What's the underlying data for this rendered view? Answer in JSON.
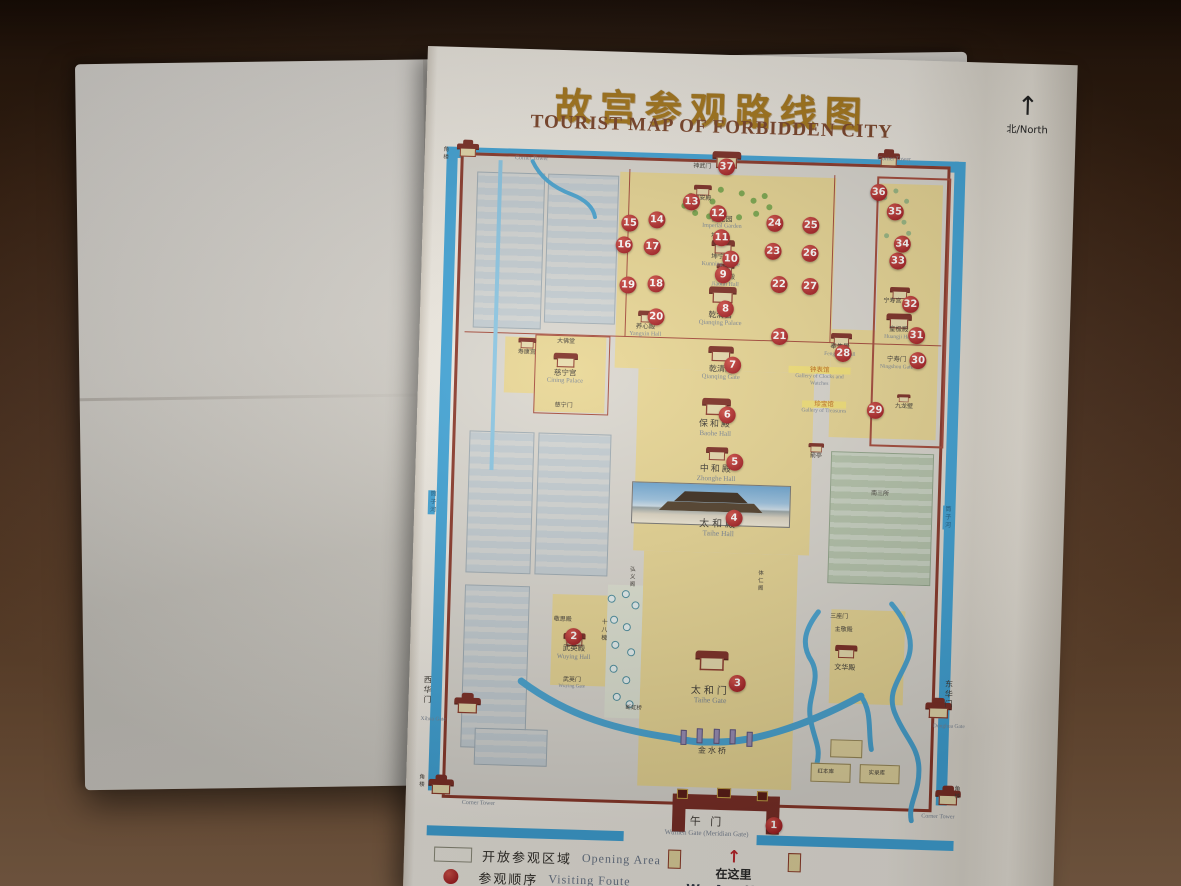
{
  "header": {
    "title_zh": "故宫参观路线图",
    "title_en": "TOURIST MAP OF FORBIDDEN CITY",
    "north_arrow": "↑",
    "north_label": "北/North"
  },
  "legend": {
    "items": [
      {
        "swatch": "area",
        "color": "#e9d795",
        "zh": "开放参观区域",
        "en": "Opening Area"
      },
      {
        "swatch": "dot",
        "color": "#b5282a",
        "zh": "参观顺序",
        "en": "Visiting Foute"
      }
    ]
  },
  "you_are_here": {
    "arrow": "↑",
    "zh": "在这里",
    "en": "We Are Here"
  },
  "colors": {
    "marker_red": "#b5282a",
    "open_area": "#e9d795",
    "moat_blue": "#41a5d9",
    "wall_red": "#8c392b",
    "title_gold": "#a8791c"
  },
  "map": {
    "markers": [
      {
        "n": 1,
        "x": 65.1,
        "y": 96.7
      },
      {
        "n": 2,
        "x": 27.6,
        "y": 70.6
      },
      {
        "n": 3,
        "x": 57.7,
        "y": 76.6
      },
      {
        "n": 4,
        "x": 56.2,
        "y": 53.0
      },
      {
        "n": 5,
        "x": 56.0,
        "y": 45.0
      },
      {
        "n": 6,
        "x": 54.4,
        "y": 38.3
      },
      {
        "n": 7,
        "x": 55.1,
        "y": 31.1
      },
      {
        "n": 8,
        "x": 53.5,
        "y": 23.1
      },
      {
        "n": 9,
        "x": 52.9,
        "y": 18.3
      },
      {
        "n": 10,
        "x": 54.2,
        "y": 16.0
      },
      {
        "n": 11,
        "x": 52.4,
        "y": 13.0
      },
      {
        "n": 12,
        "x": 51.6,
        "y": 9.6
      },
      {
        "n": 13,
        "x": 46.7,
        "y": 8.0
      },
      {
        "n": 14,
        "x": 40.5,
        "y": 10.7
      },
      {
        "n": 15,
        "x": 35.6,
        "y": 11.3
      },
      {
        "n": 16,
        "x": 34.7,
        "y": 14.4
      },
      {
        "n": 17,
        "x": 39.8,
        "y": 14.6
      },
      {
        "n": 18,
        "x": 40.7,
        "y": 19.9
      },
      {
        "n": 19,
        "x": 35.6,
        "y": 20.1
      },
      {
        "n": 20,
        "x": 40.9,
        "y": 24.6
      },
      {
        "n": 21,
        "x": 63.5,
        "y": 26.9
      },
      {
        "n": 22,
        "x": 63.1,
        "y": 19.4
      },
      {
        "n": 23,
        "x": 61.9,
        "y": 14.7
      },
      {
        "n": 24,
        "x": 62.0,
        "y": 10.7
      },
      {
        "n": 25,
        "x": 68.6,
        "y": 10.9
      },
      {
        "n": 26,
        "x": 68.6,
        "y": 14.9
      },
      {
        "n": 27,
        "x": 68.8,
        "y": 19.6
      },
      {
        "n": 28,
        "x": 75.2,
        "y": 29.0
      },
      {
        "n": 29,
        "x": 81.4,
        "y": 37.0
      },
      {
        "n": 30,
        "x": 88.9,
        "y": 29.7
      },
      {
        "n": 31,
        "x": 88.5,
        "y": 26.1
      },
      {
        "n": 32,
        "x": 87.2,
        "y": 21.7
      },
      {
        "n": 33,
        "x": 84.7,
        "y": 15.6
      },
      {
        "n": 34,
        "x": 85.4,
        "y": 13.1
      },
      {
        "n": 35,
        "x": 83.9,
        "y": 8.6
      },
      {
        "n": 36,
        "x": 80.8,
        "y": 5.9
      },
      {
        "n": 37,
        "x": 52.9,
        "y": 2.9
      }
    ],
    "labels": [
      {
        "id": "wumen",
        "t": "午 门",
        "e": "Wumen Gate (Meridian Gate)",
        "x": 52.9,
        "y": 97.2,
        "zs": 11,
        "es": 7,
        "sp": 3
      },
      {
        "id": "jinshuiqiao",
        "t": "金水桥",
        "x": 53.6,
        "y": 86.3,
        "zs": 8,
        "sp": 2
      },
      {
        "id": "taihe-gate",
        "t": "太和门",
        "e": "Taihe Gate",
        "x": 52.8,
        "y": 78.4,
        "zs": 10,
        "es": 7.5,
        "sp": 3
      },
      {
        "id": "taihe-hall",
        "t": "太和殿",
        "e": "Taihe Hall",
        "x": 53.4,
        "y": 54.5,
        "zs": 10,
        "es": 7.5,
        "sp": 3
      },
      {
        "id": "zhonghe-hall",
        "t": "中和殿",
        "e": "Zhonghe Hall",
        "x": 52.7,
        "y": 46.7,
        "zs": 9,
        "es": 7,
        "sp": 2
      },
      {
        "id": "baohe-hall",
        "t": "保和殿",
        "e": "Baohe Hall",
        "x": 52.3,
        "y": 40.3,
        "zs": 9,
        "es": 7,
        "sp": 2
      },
      {
        "id": "qianqing-gate",
        "t": "乾清门",
        "e": "Qianqing Gate",
        "x": 53.0,
        "y": 32.3,
        "zs": 8,
        "es": 6.5
      },
      {
        "id": "qianqing-palace",
        "t": "乾清宫",
        "e": "Qianqing Palace",
        "x": 52.6,
        "y": 24.5,
        "zs": 8,
        "es": 6.5
      },
      {
        "id": "jiaotai-hall",
        "t": "交泰殿",
        "e": "Jiaotai Hall",
        "x": 53.3,
        "y": 19.2,
        "zs": 6.5,
        "es": 6
      },
      {
        "id": "kunning-palace",
        "t": "坤宁宫",
        "e": "Kunning Palace",
        "x": 52.4,
        "y": 16.3,
        "zs": 6.5,
        "es": 6
      },
      {
        "id": "kunning-gate",
        "t": "坤宁门",
        "x": 52.1,
        "y": 12.9,
        "zs": 6
      },
      {
        "id": "imperial-garden",
        "t": "御花园",
        "e": "Imperial Garden",
        "x": 52.4,
        "y": 10.9,
        "zs": 7,
        "es": 6
      },
      {
        "id": "qinan-hall",
        "t": "钦安殿",
        "x": 48.7,
        "y": 7.6,
        "zs": 6
      },
      {
        "id": "shenwu-gate",
        "t": "神武门",
        "x": 48.5,
        "y": 3.0,
        "zs": 6
      },
      {
        "id": "cining-palace",
        "t": "慈宁宫",
        "e": "Cining Palace",
        "x": 24.6,
        "y": 33.5,
        "zs": 7.5,
        "es": 6.5
      },
      {
        "id": "cining-gate",
        "t": "慈宁门",
        "x": 24.5,
        "y": 37.7,
        "zs": 6
      },
      {
        "id": "dafotang",
        "t": "大佛堂",
        "x": 24.6,
        "y": 28.6,
        "zs": 6
      },
      {
        "id": "shoukang-palace",
        "t": "寿康宫",
        "x": 17.5,
        "y": 30.3,
        "zs": 6
      },
      {
        "id": "yangxin-hall",
        "t": "养心殿",
        "e": "Yangxin Hall",
        "x": 39.0,
        "y": 26.6,
        "zs": 6.5,
        "es": 6
      },
      {
        "id": "fengxian-hall",
        "t": "奉先殿",
        "e": "Fengxian Hall",
        "x": 74.6,
        "y": 28.6,
        "zs": 6.5,
        "es": 5.5
      },
      {
        "id": "clocks-gallery",
        "t": "钟表馆",
        "e": "Gallery of Clocks and Watches",
        "x": 71.0,
        "y": 32.4,
        "zs": 6.5,
        "es": 5.5,
        "hl": 1,
        "w": 62
      },
      {
        "id": "treasures-gallery",
        "t": "珍宝馆",
        "e": "Gallery of Treasures",
        "x": 72.0,
        "y": 36.8,
        "zs": 6.5,
        "es": 5.5,
        "hl": 1
      },
      {
        "id": "nine-dragon-screen",
        "t": "九龙壁",
        "x": 86.6,
        "y": 36.4,
        "zs": 6
      },
      {
        "id": "ningshou-palace",
        "t": "宁寿宫",
        "x": 83.9,
        "y": 21.4,
        "zs": 6
      },
      {
        "id": "huangji-hall",
        "t": "皇极殿",
        "e": "Huangji Hall",
        "x": 85.2,
        "y": 25.9,
        "zs": 6.5,
        "es": 5.5
      },
      {
        "id": "ningshou-gate",
        "t": "宁寿门",
        "e": "Ningshou Gate",
        "x": 85.0,
        "y": 30.2,
        "zs": 6.5,
        "es": 5.5
      },
      {
        "id": "sanzuomen",
        "t": "三座门",
        "x": 75.9,
        "y": 66.7,
        "zs": 6
      },
      {
        "id": "zhujing-hall",
        "t": "主敬殿",
        "x": 76.8,
        "y": 68.6,
        "zs": 6
      },
      {
        "id": "wenhua-hall",
        "t": "文华殿",
        "x": 77.2,
        "y": 73.9,
        "zs": 7
      },
      {
        "id": "wuying-hall",
        "t": "武英殿",
        "e": "Wuying Hall",
        "x": 27.7,
        "y": 72.9,
        "zs": 7.5,
        "es": 6.5
      },
      {
        "id": "wuying-gate",
        "t": "武英门",
        "e": "Wuying Gate",
        "x": 27.5,
        "y": 77.3,
        "zs": 6,
        "es": 5
      },
      {
        "id": "jingsi-hall",
        "t": "敬思殿",
        "x": 25.5,
        "y": 68.3,
        "zs": 6
      },
      {
        "id": "shibahuai",
        "t": "十八槐",
        "x": 32.8,
        "y": 69.5,
        "zs": 6,
        "v": 1
      },
      {
        "id": "duanhong-bridge",
        "t": "断虹桥",
        "x": 38.9,
        "y": 80.6,
        "zs": 5.5
      },
      {
        "id": "xihua-gate",
        "t": "西华门",
        "x": 1.2,
        "y": 78.8,
        "zs": 8,
        "v": 1
      },
      {
        "id": "xihua-gate-en",
        "e": "Xihua Gate",
        "x": 2.4,
        "y": 83.0,
        "es": 5.5
      },
      {
        "id": "donghua-gate",
        "t": "东华门",
        "x": 96.3,
        "y": 77.3,
        "zs": 8,
        "v": 1
      },
      {
        "id": "donghua-gate-en",
        "e": "Donghua Gate",
        "x": 96.5,
        "y": 81.8,
        "es": 5.5
      },
      {
        "id": "tongzi-river-west",
        "t": "筒子河",
        "x": 0.9,
        "y": 52.0,
        "zs": 6,
        "v": 1,
        "moat": 1
      },
      {
        "id": "tongzi-river-east",
        "t": "筒子河",
        "x": 94.9,
        "y": 52.0,
        "zs": 6,
        "v": 1,
        "moat": 1
      },
      {
        "id": "corner-tower-nw-en",
        "e": "Corner Tower",
        "x": 17.3,
        "y": 2.6,
        "es": 6
      },
      {
        "id": "corner-tower-ne-en",
        "e": "Corner Tower",
        "x": 83.5,
        "y": 1.2,
        "es": 6
      },
      {
        "id": "corner-tower-sw-en",
        "e": "Corner Tower",
        "x": 11.1,
        "y": 94.8,
        "es": 6
      },
      {
        "id": "corner-tower-se-en",
        "e": "Corner Tower",
        "x": 95.0,
        "y": 94.9,
        "es": 6
      },
      {
        "id": "corner-tower-nw-zh",
        "t": "角楼",
        "x": 1.5,
        "y": 2.2,
        "zs": 5.5,
        "v": 1
      },
      {
        "id": "corner-tower-sw-zh",
        "t": "角楼",
        "x": 0.5,
        "y": 91.9,
        "zs": 5.5,
        "v": 1
      },
      {
        "id": "corner-tower-se-zh",
        "t": "角楼",
        "x": 98.2,
        "y": 91.3,
        "zs": 5.5,
        "v": 1
      },
      {
        "id": "hongbenku",
        "t": "红本库",
        "x": 74.3,
        "y": 88.8,
        "zs": 5.5
      },
      {
        "id": "shiluku",
        "t": "实录库",
        "x": 83.6,
        "y": 88.8,
        "zs": 5.5
      },
      {
        "id": "nansansuo",
        "t": "南三所",
        "x": 82.7,
        "y": 49.0,
        "zs": 6
      },
      {
        "id": "jianting",
        "t": "箭亭",
        "x": 70.8,
        "y": 43.9,
        "zs": 6
      },
      {
        "id": "tirenge",
        "t": "体仁阁",
        "x": 61.2,
        "y": 61.8,
        "zs": 5.5,
        "v": 1
      },
      {
        "id": "hongyige",
        "t": "弘义阁",
        "x": 37.8,
        "y": 61.8,
        "zs": 5.5,
        "v": 1
      }
    ],
    "building_icons": [
      {
        "name": "shenwu-gate-hall-icon",
        "x": 52.9,
        "y": 1.9,
        "s": 1.3
      },
      {
        "name": "corner-tower-nw-icon",
        "x": 5.7,
        "y": 1.6,
        "s": 1,
        "tower": 1
      },
      {
        "name": "corner-tower-ne-icon",
        "x": 82.5,
        "y": 1.2,
        "s": 1,
        "tower": 1
      },
      {
        "name": "corner-tower-sw-icon",
        "x": 4.2,
        "y": 92.6,
        "s": 1.15,
        "tower": 1
      },
      {
        "name": "corner-tower-se-icon",
        "x": 96.8,
        "y": 92.0,
        "s": 1.15,
        "tower": 1
      },
      {
        "name": "qinan-hall-icon",
        "x": 48.7,
        "y": 6.3,
        "s": 0.8
      },
      {
        "name": "kunning-palace-icon",
        "x": 52.8,
        "y": 14.3,
        "s": 1.05
      },
      {
        "name": "jiaotai-hall-icon",
        "x": 53.2,
        "y": 17.4,
        "s": 0.8
      },
      {
        "name": "qianqing-palace-icon",
        "x": 52.9,
        "y": 21.2,
        "s": 1.25
      },
      {
        "name": "qianqing-gate-icon",
        "x": 52.9,
        "y": 29.6,
        "s": 1.15
      },
      {
        "name": "baohe-hall-icon",
        "x": 52.3,
        "y": 37.2,
        "s": 1.3
      },
      {
        "name": "zhonghe-hall-icon",
        "x": 52.8,
        "y": 43.8,
        "s": 1.0
      },
      {
        "name": "taihe-gate-icon",
        "x": 52.9,
        "y": 73.4,
        "s": 1.5
      },
      {
        "name": "xihua-gate-icon",
        "x": 8.6,
        "y": 80.8,
        "s": 1.2,
        "tower": 1
      },
      {
        "name": "donghua-gate-icon",
        "x": 94.5,
        "y": 79.6,
        "s": 1.2,
        "tower": 1
      },
      {
        "name": "cining-palace-icon",
        "x": 24.6,
        "y": 31.2,
        "s": 1.1
      },
      {
        "name": "shoukang-palace-icon",
        "x": 17.6,
        "y": 28.9,
        "s": 0.8
      },
      {
        "name": "wuying-hall-icon",
        "x": 27.7,
        "y": 71.0,
        "s": 1.0
      },
      {
        "name": "wenhua-hall-icon",
        "x": 77.3,
        "y": 71.6,
        "s": 1.0
      },
      {
        "name": "huangji-hall-icon",
        "x": 85.3,
        "y": 24.2,
        "s": 1.15
      },
      {
        "name": "ningshou-palace-icon",
        "x": 85.3,
        "y": 20.2,
        "s": 0.9
      },
      {
        "name": "fengxian-hall-icon",
        "x": 74.8,
        "y": 27.0,
        "s": 0.95
      },
      {
        "name": "yangxin-hall-icon",
        "x": 39.4,
        "y": 24.6,
        "s": 0.9
      },
      {
        "name": "jianting-pavilion-icon",
        "x": 70.8,
        "y": 42.6,
        "s": 0.7
      },
      {
        "name": "nine-dragon-screen-icon",
        "x": 86.5,
        "y": 35.2,
        "s": 0.6
      }
    ]
  }
}
